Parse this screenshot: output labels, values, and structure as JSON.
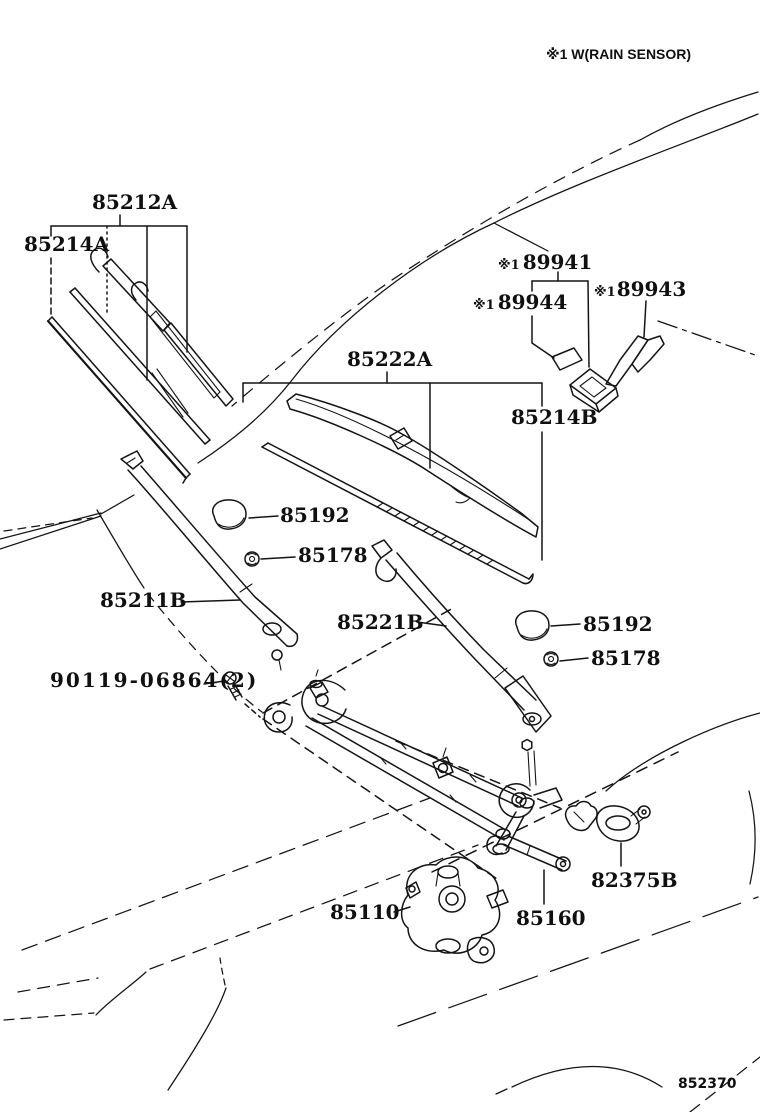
{
  "colors": {
    "ink": "#141414",
    "background": "#ffffff"
  },
  "header": {
    "note": "※1 W(RAIN SENSOR)"
  },
  "footer": {
    "diagram_code": "852370"
  },
  "labels": [
    {
      "text": "85212A"
    },
    {
      "text": "85214A"
    },
    {
      "prefix": "※1",
      "text": "89941"
    },
    {
      "prefix": "※1",
      "text": "89944"
    },
    {
      "prefix": "※1",
      "text": "89943"
    },
    {
      "text": "85222A"
    },
    {
      "text": "85214B"
    },
    {
      "text": "85192"
    },
    {
      "text": "85178"
    },
    {
      "text": "85211B"
    },
    {
      "text": "85221B"
    },
    {
      "text": "85192"
    },
    {
      "text": "85178"
    },
    {
      "text": "90119-06864(2)"
    },
    {
      "text": "82375B"
    },
    {
      "text": "85110"
    },
    {
      "text": "85160"
    }
  ],
  "icons": [
    "wiper-blade-icon",
    "wiper-arm-icon",
    "pivot-cap-icon",
    "nut-icon",
    "bolt-icon",
    "rain-sensor-icon",
    "motor-icon",
    "clip-icon"
  ]
}
